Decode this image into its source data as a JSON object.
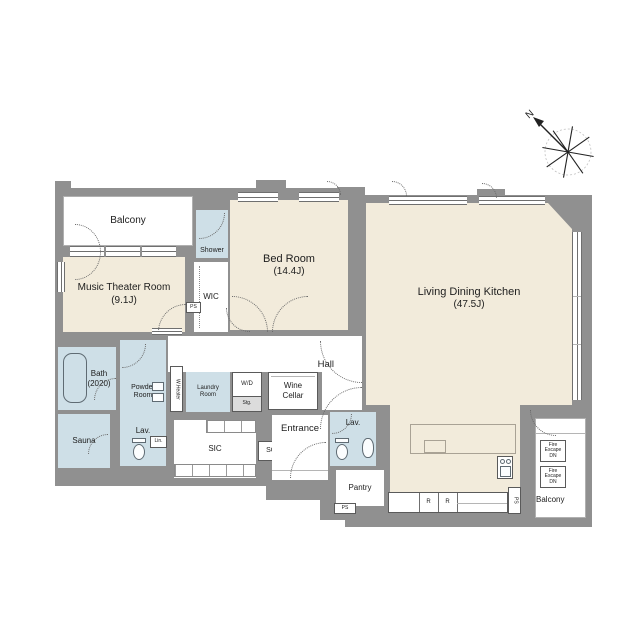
{
  "compass": {
    "north": "N"
  },
  "rooms": {
    "balcony_top": {
      "label": "Balcony"
    },
    "shower": {
      "label": "Shower"
    },
    "wic": {
      "label": "WIC"
    },
    "wic_ps": {
      "label": "PS"
    },
    "music_theater": {
      "name": "Music Theater Room",
      "size": "(9.1J)"
    },
    "bed_room": {
      "name": "Bed Room",
      "size": "(14.4J)"
    },
    "ldk": {
      "name": "Living Dining Kitchen",
      "size": "(47.5J)"
    },
    "hall": {
      "label": "Hall"
    },
    "bath": {
      "name": "Bath",
      "size": "(2020)"
    },
    "powder_room": {
      "label": "Powder Room"
    },
    "lav_left": {
      "label": "Lav."
    },
    "linen": {
      "label": "Lin."
    },
    "sauna": {
      "label": "Sauna"
    },
    "water_heater": {
      "label": "W.Heater"
    },
    "laundry_room": {
      "label": "Laundry Room"
    },
    "wd_storage": {
      "top": "W/D",
      "bottom": "Stg."
    },
    "wine_cellar": {
      "label": "Wine Cellar"
    },
    "sic": {
      "label": "SIC"
    },
    "sc": {
      "label": "SC"
    },
    "entrance": {
      "label": "Entrance"
    },
    "lav_right": {
      "label": "Lav."
    },
    "pantry": {
      "label": "Pantry"
    },
    "pantry_ps": {
      "label": "PS"
    },
    "kitchen_ps": {
      "label": "PS"
    },
    "fridge_r1": {
      "label": "R"
    },
    "fridge_r2": {
      "label": "R"
    },
    "balcony_bottom": {
      "label": "Balcony"
    },
    "fire_escape": {
      "line1": "Fire",
      "line2": "Escape",
      "line3": "DN"
    }
  },
  "colors": {
    "wall": "#909090",
    "room": "#f2ebdb",
    "wet_area": "#cedfe7",
    "floor": "#ffffff"
  }
}
